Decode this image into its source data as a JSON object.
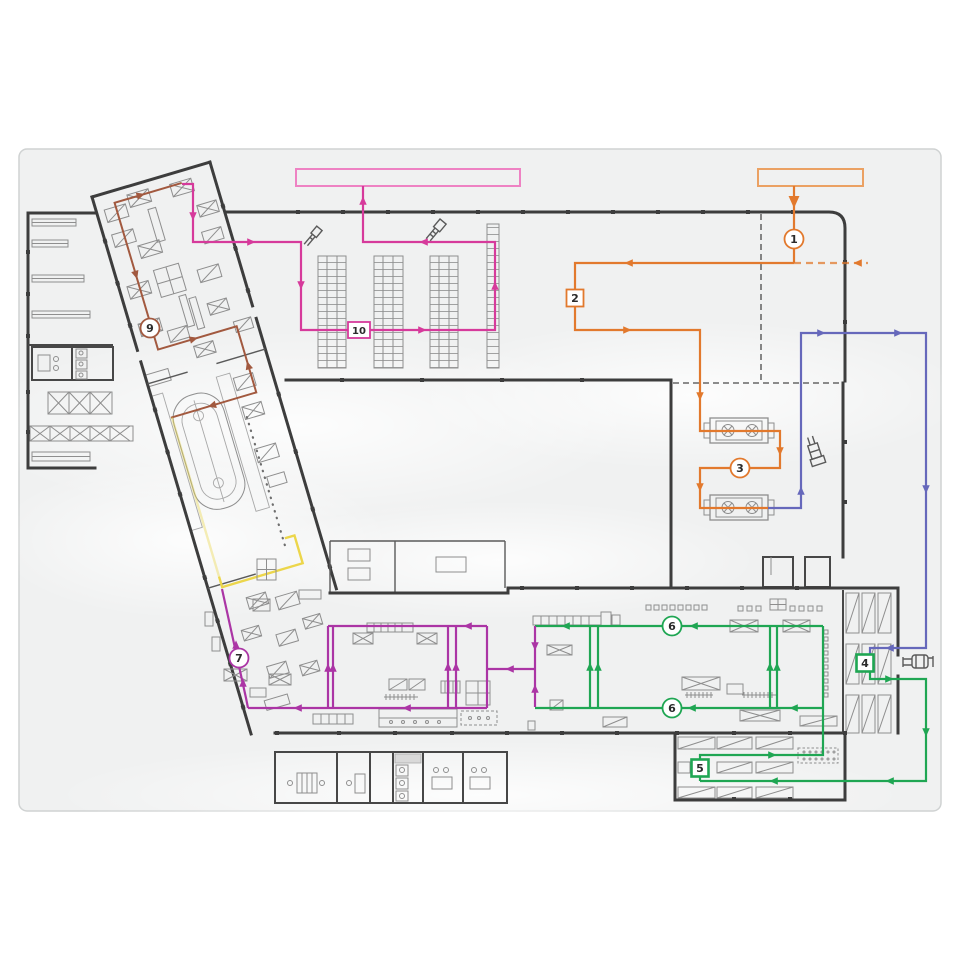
{
  "diagram": {
    "type": "facility-material-flow-plan",
    "colors": {
      "orange": "#e2792d",
      "orange_light": "#eba163",
      "blue": "#6668bb",
      "green": "#1fa653",
      "magenta_route10": "#d63a9b",
      "magenta_route7": "#ab35a5",
      "pink_source": "#ee82c3",
      "brown": "#a2593f",
      "yellow": "#ecd64b",
      "wall": "#3d3d3d",
      "panel_bg": "#f0f1f1"
    },
    "flow_rectangles": [
      {
        "name": "flow-source-pink",
        "x": 296,
        "y": 169,
        "w": 224,
        "h": 17,
        "color": "#ee82c3"
      },
      {
        "name": "flow-source-orange",
        "x": 758,
        "y": 169,
        "w": 105,
        "h": 17,
        "color": "#eba163"
      }
    ],
    "routes": [
      {
        "name": "route-orange-1-2-3",
        "color": "#e2792d",
        "width": 2.2,
        "segments": [
          [
            [
              794,
              186
            ],
            [
              794,
              263
            ]
          ],
          [
            [
              794,
              263
            ],
            [
              575,
              263
            ],
            [
              575,
              330
            ],
            [
              700,
              330
            ],
            [
              700,
              431
            ],
            [
              780,
              431
            ],
            [
              780,
              468
            ],
            [
              700,
              468
            ],
            [
              700,
              508
            ],
            [
              768,
              508
            ]
          ]
        ],
        "dashed": [
          [
            [
              794,
              263
            ],
            [
              868,
              263
            ]
          ]
        ],
        "arrows": [
          {
            "x": 794,
            "y": 203,
            "dir": "down",
            "size": 7
          },
          {
            "x": 628,
            "y": 263,
            "dir": "left"
          },
          {
            "x": 857,
            "y": 263,
            "dir": "left"
          },
          {
            "x": 628,
            "y": 330,
            "dir": "right"
          },
          {
            "x": 700,
            "y": 397,
            "dir": "down"
          },
          {
            "x": 780,
            "y": 452,
            "dir": "down"
          },
          {
            "x": 700,
            "y": 488,
            "dir": "down"
          }
        ]
      },
      {
        "name": "route-blue-4",
        "color": "#6668bb",
        "width": 2.2,
        "segments": [
          [
            [
              768,
              508
            ],
            [
              801,
              508
            ],
            [
              801,
              333
            ],
            [
              926,
              333
            ],
            [
              926,
              648
            ],
            [
              870,
              648
            ],
            [
              870,
              655
            ]
          ]
        ],
        "arrows": [
          {
            "x": 801,
            "y": 490,
            "dir": "up"
          },
          {
            "x": 822,
            "y": 333,
            "dir": "right"
          },
          {
            "x": 899,
            "y": 333,
            "dir": "right"
          },
          {
            "x": 926,
            "y": 490,
            "dir": "down"
          },
          {
            "x": 889,
            "y": 648,
            "dir": "left"
          }
        ]
      },
      {
        "name": "route-green-5-6",
        "color": "#1fa653",
        "width": 2.2,
        "segments": [
          [
            [
              870,
              671
            ],
            [
              870,
              679
            ],
            [
              926,
              679
            ],
            [
              926,
              781
            ],
            [
              700,
              781
            ]
          ],
          [
            [
              700,
              781
            ],
            [
              700,
              755
            ],
            [
              823,
              755
            ],
            [
              823,
              626
            ]
          ],
          [
            [
              823,
              626
            ],
            [
              535,
              626
            ]
          ],
          [
            [
              823,
              708
            ],
            [
              535,
              708
            ]
          ],
          [
            [
              590,
              626
            ],
            [
              590,
              708
            ]
          ],
          [
            [
              598,
              626
            ],
            [
              598,
              708
            ]
          ],
          [
            [
              770,
              626
            ],
            [
              770,
              708
            ]
          ],
          [
            [
              777,
              626
            ],
            [
              777,
              708
            ]
          ]
        ],
        "arrows": [
          {
            "x": 890,
            "y": 679,
            "dir": "right"
          },
          {
            "x": 926,
            "y": 733,
            "dir": "down"
          },
          {
            "x": 889,
            "y": 781,
            "dir": "left"
          },
          {
            "x": 773,
            "y": 781,
            "dir": "left"
          },
          {
            "x": 773,
            "y": 755,
            "dir": "right"
          },
          {
            "x": 693,
            "y": 626,
            "dir": "left"
          },
          {
            "x": 565,
            "y": 626,
            "dir": "left"
          },
          {
            "x": 793,
            "y": 708,
            "dir": "left"
          },
          {
            "x": 691,
            "y": 708,
            "dir": "left"
          },
          {
            "x": 590,
            "y": 666,
            "dir": "up"
          },
          {
            "x": 598,
            "y": 666,
            "dir": "up"
          },
          {
            "x": 770,
            "y": 666,
            "dir": "up"
          },
          {
            "x": 777,
            "y": 666,
            "dir": "up"
          }
        ]
      },
      {
        "name": "route-magenta-7",
        "color": "#ab35a5",
        "width": 2.2,
        "segments": [
          [
            [
              535,
              626
            ],
            [
              535,
              707
            ]
          ],
          [
            [
              535,
              669
            ],
            [
              487,
              669
            ]
          ],
          [
            [
              487,
              626
            ],
            [
              487,
              708
            ]
          ],
          [
            [
              487,
              626
            ],
            [
              328,
              626
            ]
          ],
          [
            [
              328,
              626
            ],
            [
              328,
              708
            ]
          ],
          [
            [
              487,
              708
            ],
            [
              248,
              708
            ]
          ],
          [
            [
              333,
              626
            ],
            [
              333,
              708
            ]
          ],
          [
            [
              448,
              626
            ],
            [
              448,
              708
            ]
          ],
          [
            [
              456,
              626
            ],
            [
              456,
              708
            ]
          ],
          [
            [
              248,
              708
            ],
            [
              246,
              698
            ],
            [
              222,
              589
            ]
          ]
        ],
        "arrows": [
          {
            "x": 535,
            "y": 647,
            "dir": "down"
          },
          {
            "x": 535,
            "y": 688,
            "dir": "up"
          },
          {
            "x": 509,
            "y": 669,
            "dir": "left"
          },
          {
            "x": 467,
            "y": 626,
            "dir": "left"
          },
          {
            "x": 406,
            "y": 708,
            "dir": "left"
          },
          {
            "x": 297,
            "y": 708,
            "dir": "left"
          },
          {
            "x": 328,
            "y": 667,
            "dir": "up"
          },
          {
            "x": 333,
            "y": 667,
            "dir": "up"
          },
          {
            "x": 448,
            "y": 666,
            "dir": "up"
          },
          {
            "x": 456,
            "y": 666,
            "dir": "up"
          },
          {
            "x": 236,
            "y": 644,
            "dir": "up"
          },
          {
            "x": 243,
            "y": 682,
            "dir": "up"
          }
        ]
      },
      {
        "name": "route-magenta-10",
        "color": "#d63a9b",
        "width": 2.2,
        "segments": [
          [
            [
              182,
              184
            ],
            [
              193,
              184
            ],
            [
              193,
              242
            ],
            [
              301,
              242
            ],
            [
              301,
              330
            ],
            [
              495,
              330
            ],
            [
              495,
              242
            ],
            [
              363,
              242
            ],
            [
              363,
              186
            ]
          ]
        ],
        "arrows": [
          {
            "x": 193,
            "y": 217,
            "dir": "down"
          },
          {
            "x": 252,
            "y": 242,
            "dir": "right"
          },
          {
            "x": 301,
            "y": 286,
            "dir": "down"
          },
          {
            "x": 423,
            "y": 330,
            "dir": "right"
          },
          {
            "x": 495,
            "y": 285,
            "dir": "up"
          },
          {
            "x": 423,
            "y": 242,
            "dir": "left"
          },
          {
            "x": 363,
            "y": 200,
            "dir": "up"
          }
        ]
      },
      {
        "name": "route-brown-9",
        "group": "rotated",
        "color": "#a2593f",
        "width": 2,
        "segments": [
          [
            [
              90,
              12
            ],
            [
              20,
              12
            ],
            [
              20,
              165
            ],
            [
              102,
              165
            ],
            [
              102,
              234
            ],
            [
              13,
              234
            ]
          ]
        ],
        "arrows": [
          {
            "x": 48,
            "y": 12,
            "dir": "right"
          },
          {
            "x": 20,
            "y": 88,
            "dir": "down"
          },
          {
            "x": 58,
            "y": 165,
            "dir": "right"
          },
          {
            "x": 102,
            "y": 205,
            "dir": "up"
          },
          {
            "x": 55,
            "y": 234,
            "dir": "left"
          }
        ]
      },
      {
        "name": "route-yellow",
        "group": "rotated",
        "color": "#ecd64b",
        "width": 2.4,
        "segments": [
          [
            [
              14,
              400
            ],
            [
              14,
              411
            ],
            [
              98,
              411
            ],
            [
              98,
              382
            ],
            [
              88,
              382
            ]
          ]
        ],
        "dashedopacity": [
          [
            [
              14,
              234
            ],
            [
              14,
              400
            ]
          ]
        ],
        "arrows": []
      }
    ],
    "markers": [
      {
        "shape": "circle",
        "label": "1",
        "x": 794,
        "y": 239,
        "color": "#e2792d"
      },
      {
        "shape": "square",
        "label": "2",
        "x": 575,
        "y": 298,
        "color": "#e2792d",
        "w": 17,
        "h": 17
      },
      {
        "shape": "circle",
        "label": "3",
        "x": 740,
        "y": 468,
        "color": "#e2792d"
      },
      {
        "shape": "square",
        "label": "4",
        "x": 865,
        "y": 663,
        "color": "#1fa653",
        "w": 17,
        "h": 17,
        "bold": true
      },
      {
        "shape": "square",
        "label": "5",
        "x": 700,
        "y": 768,
        "color": "#1fa653",
        "w": 17,
        "h": 17,
        "bold": true
      },
      {
        "shape": "circle",
        "label": "6",
        "x": 672,
        "y": 626,
        "color": "#1fa653"
      },
      {
        "shape": "circle",
        "label": "6",
        "x": 672,
        "y": 708,
        "color": "#1fa653"
      },
      {
        "shape": "circle",
        "label": "7",
        "x": 239,
        "y": 658,
        "color": "#ab35a5"
      },
      {
        "shape": "circle",
        "label": "9",
        "x": 150,
        "y": 328,
        "color": "#a2593f"
      },
      {
        "shape": "square",
        "label": "10",
        "x": 359,
        "y": 330,
        "color": "#d63a9b",
        "w": 22,
        "h": 16
      }
    ]
  }
}
